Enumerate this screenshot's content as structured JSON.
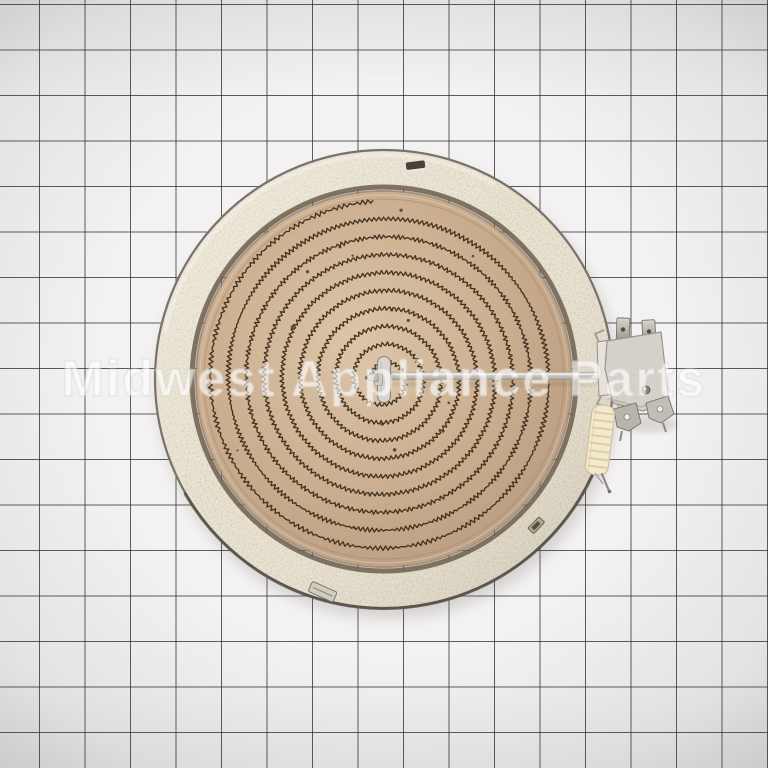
{
  "watermark": {
    "text": "Midwest Appliance Parts"
  },
  "scene": {
    "background_color": "#f3f1f1",
    "grid": {
      "spacing": 45.5,
      "line_color": "rgba(40,40,46,0.75)",
      "offset_x": 39,
      "offset_y": 4
    }
  },
  "element": {
    "label": "radiant-surface-heating-element",
    "center": {
      "x": 384,
      "y": 379
    },
    "outer_radius": 229,
    "rim": {
      "inner_radius": 192,
      "fill": "#eae3d2",
      "edge_color": "#77736c",
      "edge_dark": "#514d46",
      "gap_ring_color": "#6e5f4c",
      "highlight": "#fbf6ea"
    },
    "dish": {
      "radius": 187,
      "fill": "#cbae8f",
      "fill_light": "#dcc5a8",
      "fill_dark": "#b2947a",
      "groove_color": "#a98d6f",
      "highlight_ring": "#e3cdb0"
    },
    "coil": {
      "turns": 9.2,
      "inner_radius": 13,
      "outer_radius": 178,
      "color": "#3a2917",
      "amplitude": 2.2,
      "wavelength": 4.8,
      "stroke_width": 1.35,
      "start_angle": 3.4,
      "speck_color": "#46321f",
      "speck_count": 16
    },
    "hub": {
      "fill": "#d9d6cf",
      "stroke": "#8a8680",
      "pin_fill": "#bfbbb2",
      "tip_color": "#59554e"
    },
    "rod": {
      "x_end": 614,
      "stroke": "#8e8a80",
      "highlight": "#f6f4f0",
      "shadow": "#6b5638"
    },
    "terminal_block": {
      "fill": "#d8d4cc",
      "stroke": "#99948b",
      "spade_stroke": "#6d6962",
      "hole_color": "#4e4a44",
      "rivet_color": "#85817a",
      "bracket_fill": "#b8b4ab",
      "bracket_hole": "#eeede9",
      "clip_fill": "#e6e3dd"
    },
    "insulator": {
      "fill": "#f3e9cd",
      "stroke": "#cdbf9f",
      "rib_color": "#d9caa6",
      "pin_color": "#8d8981"
    },
    "tabs": {
      "slot_color": "#46413a",
      "clip_fill": "#d3cdc0",
      "clip_stroke": "#7c776e",
      "notch_fill": "#b4a88e",
      "notch_dark": "#55503f"
    }
  }
}
